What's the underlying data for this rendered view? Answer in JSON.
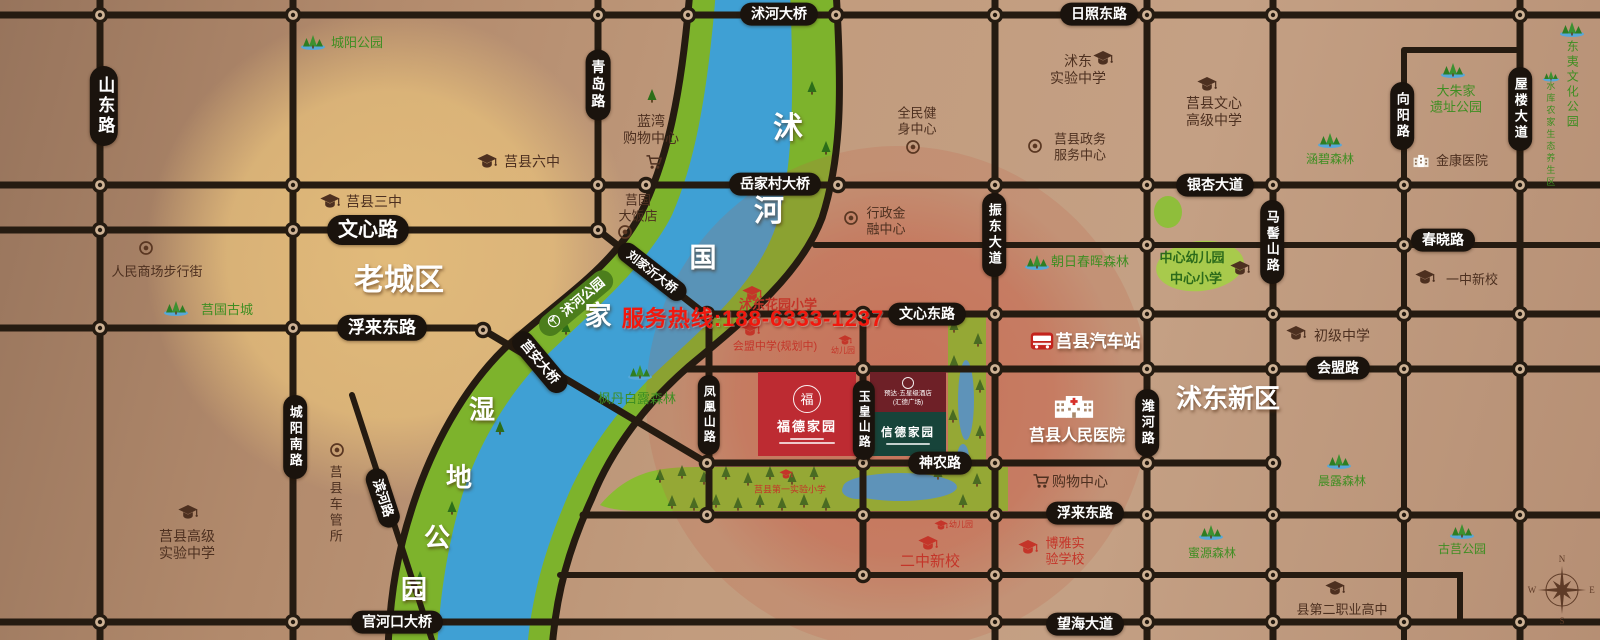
{
  "hotline": "服务热线:188-6333-1237",
  "projects": {
    "main": {
      "seal": "福",
      "name": "福德家园"
    },
    "hotel": {
      "line1": "预达·五星级酒店",
      "line2": "(汇德广场)"
    },
    "sister": {
      "name": "信德家园"
    }
  },
  "compass": {
    "n": "N",
    "e": "E",
    "s": "S",
    "w": "W"
  },
  "labels": [
    {
      "n": "road-label-shandong-road",
      "k": "pill",
      "t": "山东路",
      "x": 104,
      "y": 106,
      "v": 1,
      "s": 17
    },
    {
      "n": "road-label-qingdao-road",
      "k": "pill",
      "t": "青岛路",
      "x": 598,
      "y": 85,
      "v": 1,
      "s": 14
    },
    {
      "n": "road-label-chengyang-south-road",
      "k": "pill",
      "t": "城阳南路",
      "x": 295,
      "y": 437,
      "v": 1,
      "s": 13
    },
    {
      "n": "road-label-wenxin-road",
      "k": "pill",
      "t": "文心路",
      "x": 368,
      "y": 230,
      "s": 20
    },
    {
      "n": "road-label-fulai-east-road-west",
      "k": "pill",
      "t": "浮来东路",
      "x": 382,
      "y": 328,
      "s": 17
    },
    {
      "n": "road-label-binhe-road",
      "k": "pill",
      "t": "滨河路",
      "x": 383,
      "y": 498,
      "r": 72,
      "s": 13
    },
    {
      "n": "bridge-label-guanhekou",
      "k": "pill",
      "t": "官河口大桥",
      "x": 397,
      "y": 622,
      "s": 14
    },
    {
      "n": "bridge-label-shuhe",
      "k": "pill",
      "t": "沭河大桥",
      "x": 779,
      "y": 14,
      "s": 14
    },
    {
      "n": "bridge-label-yuejiacun",
      "k": "pill",
      "t": "岳家村大桥",
      "x": 775,
      "y": 184,
      "s": 14
    },
    {
      "n": "bridge-label-liujiayi",
      "k": "pill",
      "t": "刘家沂大桥",
      "x": 652,
      "y": 272,
      "r": 38,
      "s": 12
    },
    {
      "n": "bridge-label-juan",
      "k": "pill",
      "t": "莒安大桥",
      "x": 540,
      "y": 362,
      "r": 50,
      "s": 13
    },
    {
      "n": "road-label-rizhao-east-road",
      "k": "pill",
      "t": "日照东路",
      "x": 1099,
      "y": 14,
      "s": 14
    },
    {
      "n": "road-label-zhendong-avenue",
      "k": "pill",
      "t": "振东大道",
      "x": 994,
      "y": 235,
      "v": 1,
      "s": 13
    },
    {
      "n": "road-label-wenxin-east-road",
      "k": "pill",
      "t": "文心东路",
      "x": 927,
      "y": 314,
      "s": 14
    },
    {
      "n": "road-label-shennong-road",
      "k": "pill",
      "t": "神农路",
      "x": 940,
      "y": 463,
      "s": 14
    },
    {
      "n": "road-label-yinxing-avenue",
      "k": "pill",
      "t": "银杏大道",
      "x": 1215,
      "y": 185,
      "s": 14
    },
    {
      "n": "road-label-majishan-road",
      "k": "pill",
      "t": "马髻山路",
      "x": 1272,
      "y": 242,
      "v": 1,
      "s": 13
    },
    {
      "n": "road-label-weihe-road",
      "k": "pill",
      "t": "潍河路",
      "x": 1147,
      "y": 423,
      "v": 1,
      "s": 13
    },
    {
      "n": "road-label-huimeng-road",
      "k": "pill",
      "t": "会盟路",
      "x": 1338,
      "y": 368,
      "s": 14
    },
    {
      "n": "road-label-chunxiao-road",
      "k": "pill",
      "t": "春晓路",
      "x": 1443,
      "y": 240,
      "s": 14
    },
    {
      "n": "road-label-xiangyang-road",
      "k": "pill",
      "t": "向阳路",
      "x": 1402,
      "y": 116,
      "v": 1,
      "s": 13
    },
    {
      "n": "road-label-wulou-avenue",
      "k": "pill",
      "t": "屋楼大道",
      "x": 1520,
      "y": 109,
      "v": 1,
      "s": 13
    },
    {
      "n": "road-label-fulai-east-road-east",
      "k": "pill",
      "t": "浮来东路",
      "x": 1085,
      "y": 513,
      "s": 14
    },
    {
      "n": "road-label-wanghai-avenue",
      "k": "pill",
      "t": "望海大道",
      "x": 1085,
      "y": 624,
      "s": 14
    },
    {
      "n": "road-label-fenghuangshan-road",
      "k": "pill",
      "t": "凤凰山路",
      "x": 709,
      "y": 415,
      "v": 1,
      "s": 12
    },
    {
      "n": "road-label-yuhuangshan-road",
      "k": "pill",
      "t": "玉皇山路",
      "x": 864,
      "y": 420,
      "v": 1,
      "s": 12
    },
    {
      "n": "shuhe-park-label",
      "k": "parkpill",
      "t": "沭河公园",
      "x": 576,
      "y": 303,
      "r": -40,
      "s": 13
    },
    {
      "n": "chengyang-park-icon",
      "k": "icon",
      "i": "tree",
      "x": 313,
      "y": 42
    },
    {
      "n": "chengyang-park-label",
      "k": "text",
      "t": "城阳公园",
      "x": 357,
      "y": 43,
      "c": "green",
      "s": 13
    },
    {
      "n": "juxian-no3-school-icon",
      "k": "icon",
      "i": "cap",
      "c": "brown",
      "x": 330,
      "y": 201
    },
    {
      "n": "juxian-no3-school-label",
      "k": "text",
      "t": "莒县三中",
      "x": 374,
      "y": 202,
      "c": "brown",
      "s": 14
    },
    {
      "n": "juxian-no6-school-icon",
      "k": "icon",
      "i": "cap",
      "c": "brown",
      "x": 487,
      "y": 161
    },
    {
      "n": "juxian-no6-school-label",
      "k": "text",
      "t": "莒县六中",
      "x": 532,
      "y": 162,
      "c": "brown",
      "s": 14
    },
    {
      "n": "renmin-mall-icon",
      "k": "icon",
      "i": "ring",
      "x": 146,
      "y": 248
    },
    {
      "n": "renmin-mall-label",
      "k": "text",
      "t": "人民商场步行街",
      "x": 157,
      "y": 272,
      "c": "brown",
      "s": 13
    },
    {
      "n": "juguo-old-city-icon",
      "k": "icon",
      "i": "tree",
      "x": 176,
      "y": 308
    },
    {
      "n": "juguo-old-city-label",
      "k": "text",
      "t": "莒国古城",
      "x": 227,
      "y": 310,
      "c": "green",
      "s": 13
    },
    {
      "n": "old-town-area-label",
      "k": "text",
      "t": "老城区",
      "x": 399,
      "y": 281,
      "c": "white",
      "s": 30,
      "w": 1,
      "sh": 1
    },
    {
      "n": "juxian-senior-exp-school-icon",
      "k": "icon",
      "i": "cap",
      "c": "brown",
      "x": 188,
      "y": 512
    },
    {
      "n": "juxian-senior-exp-school-label",
      "k": "text",
      "ls": [
        "莒县高级",
        "实验中学"
      ],
      "x": 187,
      "y": 545,
      "c": "brown",
      "s": 14
    },
    {
      "n": "vehicle-admin-office-icon",
      "k": "icon",
      "i": "ring",
      "x": 337,
      "y": 450
    },
    {
      "n": "vehicle-admin-office-label",
      "k": "text",
      "t": "莒县车管所",
      "x": 335,
      "y": 505,
      "c": "brown",
      "s": 13,
      "v": 1
    },
    {
      "n": "lanwan-mall-label",
      "k": "text",
      "ls": [
        "蓝湾",
        "购物中心"
      ],
      "x": 651,
      "y": 130,
      "c": "brown",
      "s": 14
    },
    {
      "n": "lanwan-mall-cart-icon",
      "k": "icon",
      "i": "cart",
      "x": 654,
      "y": 162
    },
    {
      "n": "juguo-hotel-label",
      "k": "text",
      "ls": [
        "莒国",
        "大饭店"
      ],
      "x": 638,
      "y": 208,
      "c": "brown",
      "s": 13
    },
    {
      "n": "juguo-hotel-icon",
      "k": "icon",
      "i": "ring",
      "x": 625,
      "y": 232
    },
    {
      "n": "fitness-center-label",
      "k": "text",
      "ls": [
        "全民健",
        "身中心"
      ],
      "x": 917,
      "y": 121,
      "c": "brown",
      "s": 13
    },
    {
      "n": "fitness-center-icon",
      "k": "icon",
      "i": "ring",
      "x": 913,
      "y": 147
    },
    {
      "n": "admin-finance-center-icon",
      "k": "icon",
      "i": "ring",
      "x": 851,
      "y": 218
    },
    {
      "n": "admin-finance-center-label",
      "k": "text",
      "ls": [
        "行政金",
        "融中心"
      ],
      "x": 886,
      "y": 221,
      "c": "brown",
      "s": 13
    },
    {
      "n": "shudong-exp-school-label",
      "k": "text",
      "ls": [
        "沭东",
        "实验中学"
      ],
      "x": 1078,
      "y": 70,
      "c": "brown",
      "s": 14
    },
    {
      "n": "shudong-exp-school-icon",
      "k": "icon",
      "i": "cap",
      "c": "brown",
      "x": 1103,
      "y": 58
    },
    {
      "n": "govt-service-center-icon",
      "k": "icon",
      "i": "ring",
      "x": 1035,
      "y": 146
    },
    {
      "n": "govt-service-center-label",
      "k": "text",
      "ls": [
        "莒县政务",
        "服务中心"
      ],
      "x": 1080,
      "y": 147,
      "c": "brown",
      "s": 13
    },
    {
      "n": "wenxin-high-school-icon",
      "k": "icon",
      "i": "cap",
      "c": "brown",
      "x": 1207,
      "y": 84
    },
    {
      "n": "wenxin-high-school-label",
      "k": "text",
      "ls": [
        "莒县文心",
        "高级中学"
      ],
      "x": 1214,
      "y": 112,
      "c": "brown",
      "s": 14
    },
    {
      "n": "zhaori-forest-icon",
      "k": "icon",
      "i": "tree",
      "x": 1037,
      "y": 262
    },
    {
      "n": "zhaori-forest-label",
      "k": "text",
      "t": "朝日春晖森林",
      "x": 1090,
      "y": 262,
      "c": "green",
      "s": 13
    },
    {
      "n": "central-kindergarten-label",
      "k": "text",
      "t": "中心幼儿园",
      "x": 1192,
      "y": 258,
      "c": "dgreen",
      "s": 13,
      "w": 1
    },
    {
      "n": "central-primary-label",
      "k": "text",
      "t": "中心小学",
      "x": 1196,
      "y": 279,
      "c": "dgreen",
      "s": 13,
      "w": 1
    },
    {
      "n": "central-school-cap-icon",
      "k": "icon",
      "i": "cap",
      "c": "brown",
      "x": 1240,
      "y": 268
    },
    {
      "n": "hanbi-forest-icon",
      "k": "icon",
      "i": "tree",
      "x": 1330,
      "y": 140
    },
    {
      "n": "hanbi-forest-label",
      "k": "text",
      "t": "涵碧森林",
      "x": 1330,
      "y": 159,
      "c": "green",
      "s": 12
    },
    {
      "n": "jinkang-hospital-icon",
      "k": "icon",
      "i": "hospital",
      "x": 1421,
      "y": 161
    },
    {
      "n": "jinkang-hospital-label",
      "k": "text",
      "t": "金康医院",
      "x": 1462,
      "y": 161,
      "c": "brown",
      "s": 13
    },
    {
      "n": "dazhujia-ruins-park-icon",
      "k": "icon",
      "i": "tree",
      "x": 1453,
      "y": 70
    },
    {
      "n": "dazhujia-ruins-park-label",
      "k": "text",
      "ls": [
        "大朱家",
        "遗址公园"
      ],
      "x": 1456,
      "y": 99,
      "c": "green",
      "s": 13
    },
    {
      "n": "dongyi-culture-park-icon",
      "k": "icon",
      "i": "tree",
      "x": 1572,
      "y": 29
    },
    {
      "n": "dongyi-culture-park-label",
      "k": "text",
      "t": "东夷文化公园",
      "x": 1572,
      "y": 85,
      "c": "green",
      "s": 12,
      "v": 1
    },
    {
      "n": "reservoir-farm-zone-icon",
      "k": "icon",
      "i": "tree",
      "x": 1551,
      "y": 76,
      "sm": 1
    },
    {
      "n": "reservoir-farm-zone-label",
      "k": "text",
      "t": "水库农家生态养生区",
      "x": 1550,
      "y": 135,
      "c": "green",
      "s": 9,
      "v": 1
    },
    {
      "n": "yizhong-new-campus-icon",
      "k": "icon",
      "i": "cap",
      "c": "brown",
      "x": 1425,
      "y": 277
    },
    {
      "n": "yizhong-new-campus-label",
      "k": "text",
      "t": "一中新校",
      "x": 1472,
      "y": 280,
      "c": "brown",
      "s": 13
    },
    {
      "n": "junior-middle-school-icon",
      "k": "icon",
      "i": "cap",
      "c": "brown",
      "x": 1296,
      "y": 333
    },
    {
      "n": "junior-middle-school-label",
      "k": "text",
      "t": "初级中学",
      "x": 1342,
      "y": 336,
      "c": "brown",
      "s": 14
    },
    {
      "n": "bus-station-icon",
      "k": "icon",
      "i": "bus",
      "x": 1042,
      "y": 341
    },
    {
      "n": "bus-station-label",
      "k": "text",
      "t": "莒县汽车站",
      "x": 1098,
      "y": 342,
      "c": "white",
      "s": 17,
      "w": 1,
      "sh": 1
    },
    {
      "n": "people-hospital-icon",
      "k": "icon",
      "i": "hospitalBig",
      "x": 1074,
      "y": 406
    },
    {
      "n": "people-hospital-label",
      "k": "text",
      "t": "莒县人民医院",
      "x": 1077,
      "y": 436,
      "c": "white",
      "s": 16,
      "w": 1,
      "sh": 1
    },
    {
      "n": "shudong-new-district-label",
      "k": "text",
      "t": "沭东新区",
      "x": 1228,
      "y": 399,
      "c": "white",
      "s": 26,
      "w": 1,
      "sh": 1
    },
    {
      "n": "south-mall-cart-icon",
      "k": "icon",
      "i": "cart",
      "x": 1041,
      "y": 481
    },
    {
      "n": "south-mall-label",
      "k": "text",
      "t": "购物中心",
      "x": 1080,
      "y": 482,
      "c": "brown",
      "s": 14
    },
    {
      "n": "shudong-garden-primary-icon",
      "k": "icon",
      "i": "cap",
      "c": "red",
      "x": 752,
      "y": 293
    },
    {
      "n": "shudong-garden-primary-label",
      "k": "text",
      "t": "沭东花园小学",
      "x": 778,
      "y": 305,
      "c": "red",
      "s": 13,
      "w": 1
    },
    {
      "n": "huimeng-middle-school-icon",
      "k": "icon",
      "i": "cap",
      "c": "red",
      "x": 750,
      "y": 329
    },
    {
      "n": "huimeng-middle-school-label",
      "k": "text",
      "t": "会盟中学(规划中)",
      "x": 775,
      "y": 347,
      "c": "red",
      "s": 11
    },
    {
      "n": "kindergarten-north-icon",
      "k": "icon",
      "i": "cap",
      "c": "red",
      "x": 845,
      "y": 340,
      "sm": 1
    },
    {
      "n": "kindergarten-north-label",
      "k": "text",
      "t": "幼儿园",
      "x": 843,
      "y": 351,
      "c": "red",
      "s": 8
    },
    {
      "n": "first-exp-primary-icon",
      "k": "icon",
      "i": "cap",
      "c": "red",
      "x": 786,
      "y": 474,
      "sm": 1
    },
    {
      "n": "first-exp-primary-label",
      "k": "text",
      "t": "莒县第一实验小学",
      "x": 790,
      "y": 490,
      "c": "red",
      "s": 9
    },
    {
      "n": "kindergarten-south-icon",
      "k": "icon",
      "i": "cap",
      "c": "red",
      "x": 941,
      "y": 525,
      "sm": 1
    },
    {
      "n": "kindergarten-south-label",
      "k": "text",
      "t": "幼儿园",
      "x": 961,
      "y": 525,
      "c": "red",
      "s": 8
    },
    {
      "n": "erzhong-new-campus-icon",
      "k": "icon",
      "i": "cap",
      "c": "red",
      "x": 928,
      "y": 543
    },
    {
      "n": "erzhong-new-campus-label",
      "k": "text",
      "t": "二中新校",
      "x": 930,
      "y": 562,
      "c": "red",
      "s": 15
    },
    {
      "n": "boya-exp-school-icon",
      "k": "icon",
      "i": "cap",
      "c": "red",
      "x": 1028,
      "y": 547
    },
    {
      "n": "boya-exp-school-label",
      "k": "text",
      "ls": [
        "博雅实",
        "验学校"
      ],
      "x": 1065,
      "y": 551,
      "c": "red",
      "s": 13
    },
    {
      "n": "no2-vocational-school-icon",
      "k": "icon",
      "i": "cap",
      "c": "brown",
      "x": 1335,
      "y": 588
    },
    {
      "n": "no2-vocational-school-label",
      "k": "text",
      "t": "县第二职业高中",
      "x": 1342,
      "y": 610,
      "c": "brown",
      "s": 13
    },
    {
      "n": "chenlu-forest-icon",
      "k": "icon",
      "i": "tree",
      "x": 1339,
      "y": 461
    },
    {
      "n": "chenlu-forest-label",
      "k": "text",
      "t": "晨露森林",
      "x": 1342,
      "y": 481,
      "c": "green",
      "s": 12
    },
    {
      "n": "miyuan-forest-icon",
      "k": "icon",
      "i": "tree",
      "x": 1211,
      "y": 532
    },
    {
      "n": "miyuan-forest-label",
      "k": "text",
      "t": "蜜源森林",
      "x": 1212,
      "y": 553,
      "c": "green",
      "s": 12
    },
    {
      "n": "guju-park-icon",
      "k": "icon",
      "i": "tree",
      "x": 1462,
      "y": 531
    },
    {
      "n": "guju-park-label",
      "k": "text",
      "t": "古莒公园",
      "x": 1462,
      "y": 549,
      "c": "green",
      "s": 12
    },
    {
      "n": "fengdan-forest-icon",
      "k": "icon",
      "i": "tree",
      "x": 640,
      "y": 372
    },
    {
      "n": "fengdan-forest-label",
      "k": "text",
      "t": "枫丹白露森林",
      "x": 637,
      "y": 399,
      "c": "green",
      "s": 13
    },
    {
      "n": "river-char-shu",
      "k": "text",
      "t": "沭",
      "x": 788,
      "y": 129,
      "c": "white",
      "s": 30,
      "w": 1,
      "sh": 1
    },
    {
      "n": "river-char-he",
      "k": "text",
      "t": "河",
      "x": 769,
      "y": 212,
      "c": "white",
      "s": 30,
      "w": 1,
      "sh": 1
    },
    {
      "n": "river-char-guo",
      "k": "text",
      "t": "国",
      "x": 703,
      "y": 258,
      "c": "white",
      "s": 27,
      "w": 1,
      "sh": 1
    },
    {
      "n": "river-char-jia",
      "k": "text",
      "t": "家",
      "x": 598,
      "y": 316,
      "c": "white",
      "s": 27,
      "w": 1,
      "sh": 1
    },
    {
      "n": "river-char-shi",
      "k": "text",
      "t": "湿",
      "x": 482,
      "y": 410,
      "c": "white",
      "s": 26,
      "w": 1,
      "sh": 1
    },
    {
      "n": "river-char-di",
      "k": "text",
      "t": "地",
      "x": 459,
      "y": 478,
      "c": "white",
      "s": 26,
      "w": 1,
      "sh": 1
    },
    {
      "n": "river-char-gong",
      "k": "text",
      "t": "公",
      "x": 437,
      "y": 538,
      "c": "white",
      "s": 26,
      "w": 1,
      "sh": 1
    },
    {
      "n": "river-char-yuan",
      "k": "text",
      "t": "园",
      "x": 414,
      "y": 590,
      "c": "white",
      "s": 26,
      "w": 1,
      "sh": 1
    }
  ]
}
